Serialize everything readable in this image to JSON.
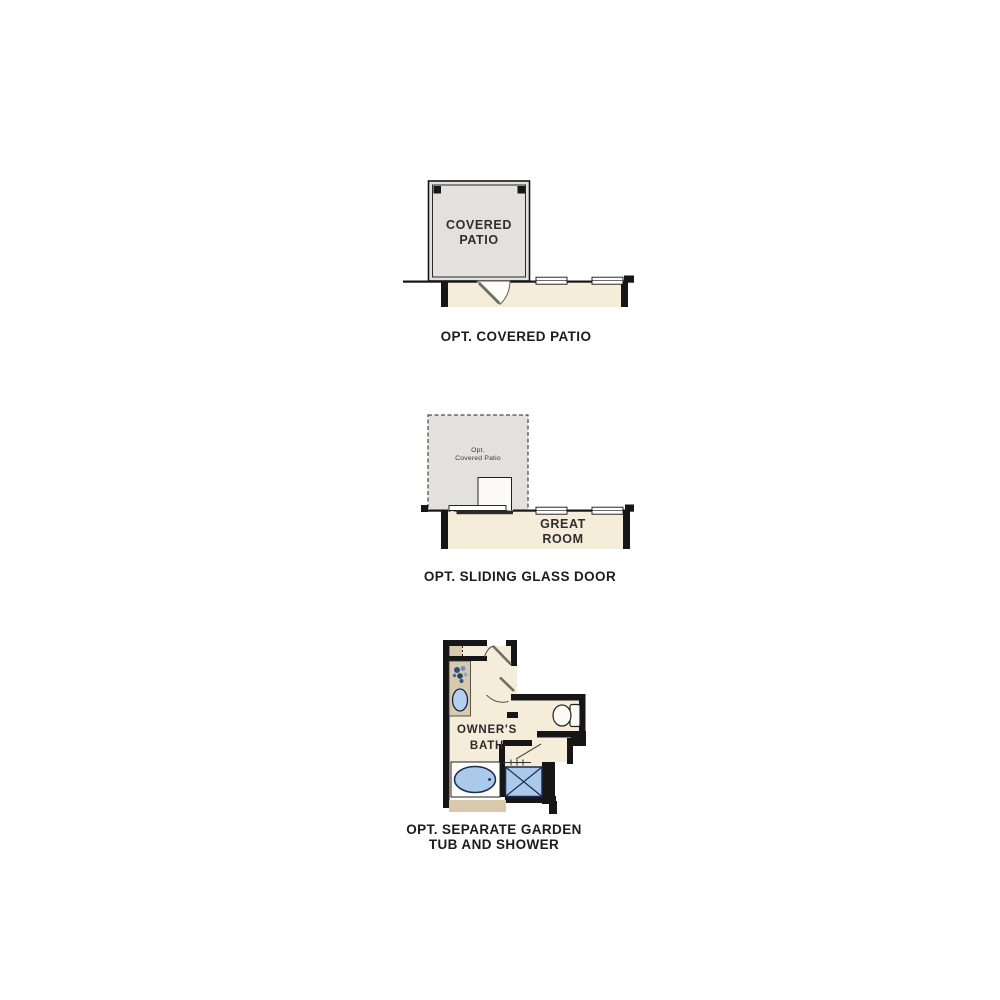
{
  "document": {
    "type": "floor-plan-options-sheet",
    "background": "#ffffff"
  },
  "colors": {
    "wall": "#161616",
    "floor_cream": "#f5ecd9",
    "patio_gray": "#e2e1de",
    "cabinet_tan": "#d8c9ad",
    "fixture_blue": "#abc9eb",
    "fixture_outline": "#1b2a4d",
    "door_leaf_gray": "#6f6f68"
  },
  "figures": [
    {
      "name": "covered-patio-option",
      "caption": "OPT. COVERED PATIO",
      "patio_label_line1": "COVERED",
      "patio_label_line2": "PATIO",
      "features": [
        "covered-patio",
        "corner-posts",
        "entry-door-swing",
        "windows",
        "interior-room"
      ]
    },
    {
      "name": "sliding-glass-door-option",
      "caption": "OPT. SLIDING GLASS DOOR",
      "patio_label_line1": "Opt.",
      "patio_label_line2": "Covered Patio",
      "room_label_line1": "GREAT",
      "room_label_line2": "ROOM",
      "features": [
        "dashed-optional-patio",
        "sliding-glass-door",
        "windows",
        "great-room"
      ]
    },
    {
      "name": "garden-tub-shower-option",
      "caption_line1": "OPT. SEPARATE GARDEN",
      "caption_line2": "TUB AND SHOWER",
      "room_label_line1": "OWNER'S",
      "room_label_line2": "BATH",
      "fixtures": [
        "linen-shelves",
        "vanity-sink",
        "flower-decor",
        "toilet",
        "garden-tub",
        "shower",
        "entry-door-swing",
        "water-closet-door-swing",
        "shower-door"
      ]
    }
  ]
}
